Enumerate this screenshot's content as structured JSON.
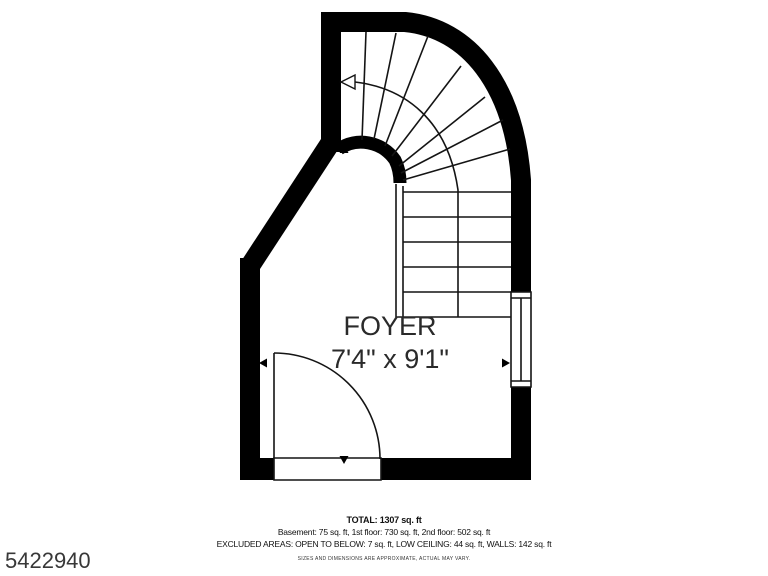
{
  "meta": {
    "listing_number": "5422940"
  },
  "room": {
    "name": "FOYER",
    "dimensions": "7'4\" x 9'1\""
  },
  "summary": {
    "total": "TOTAL: 1307 sq. ft",
    "floors": "Basement: 75 sq. ft, 1st floor: 730 sq. ft, 2nd floor: 502 sq. ft",
    "excluded": "EXCLUDED AREAS: OPEN TO BELOW: 7 sq. ft, LOW CEILING: 44 sq. ft, WALLS: 142 sq. ft",
    "disclaimer": "SIZES AND DIMENSIONS ARE APPROXIMATE, ACTUAL MAY VARY."
  },
  "plan": {
    "colors": {
      "wall": "#000000",
      "background": "#ffffff",
      "line": "#141414",
      "text": "#2a2a2a"
    },
    "walls": {
      "upper_left": "M 331,12 L 331,152",
      "top_curve": "M 321,22 L 405,22 C 468,28 514,84 521,180 L 521,480",
      "diagonal": "M 331,142 L 250,266",
      "left": "M 250,258 L 250,480",
      "bottom": "M 240,469 L 531,469",
      "stair_center": "M 339,149 C 356,137 382,141 395,160 Q 400,170 400,183"
    },
    "door": {
      "opening": "M 274,458 L 381,458 L 381,480 L 274,480 Z",
      "leaf": "M 274,353 L 274,458",
      "swing_arc": "M 274,353 A 106,106 0 0 1 380,459"
    },
    "window": {
      "opening": "M 511,292 L 531,292 L 531,387 L 511,387 Z",
      "frame_top": "M 511,298 L 531,298",
      "frame_bottom": "M 511,381 L 531,381",
      "glass": "M 521,298 L 521,381"
    },
    "stairs": {
      "treads": [
        "M 403,192 L 511,192",
        "M 403,217 L 511,217",
        "M 403,242 L 511,242",
        "M 403,267 L 511,267",
        "M 403,292 L 511,292",
        "M 396,317 L 511,317"
      ],
      "winders": [
        "M 362,140 L 366,32",
        "M 374,139 L 396,33",
        "M 385,146 L 428,36",
        "M 392,156 L 461,66",
        "M 399,166 L 485,97",
        "M 401,173 L 503,120",
        "M 403,180 L 510,149"
      ],
      "rail_outer": "M 396,184 L 396,317",
      "rail_inner": "M 403,186 L 403,317",
      "walkline": "M 355,82 C 405,88 448,120 458,190 L 458,317",
      "direction_arrow": "M 341,82 L 355,75 L 355,89 Z"
    },
    "markers": {
      "dim_left": "M 259,363 L 267,358.5 L 267,367.5 Z",
      "dim_right": "M 510,363 L 502,358.5 L 502,367.5 Z",
      "dim_top": "M 344,145 L 339.5,153 L 348.5,153 Z",
      "dim_bottom": "M 344,464 L 339.5,456 L 348.5,456 Z"
    }
  }
}
